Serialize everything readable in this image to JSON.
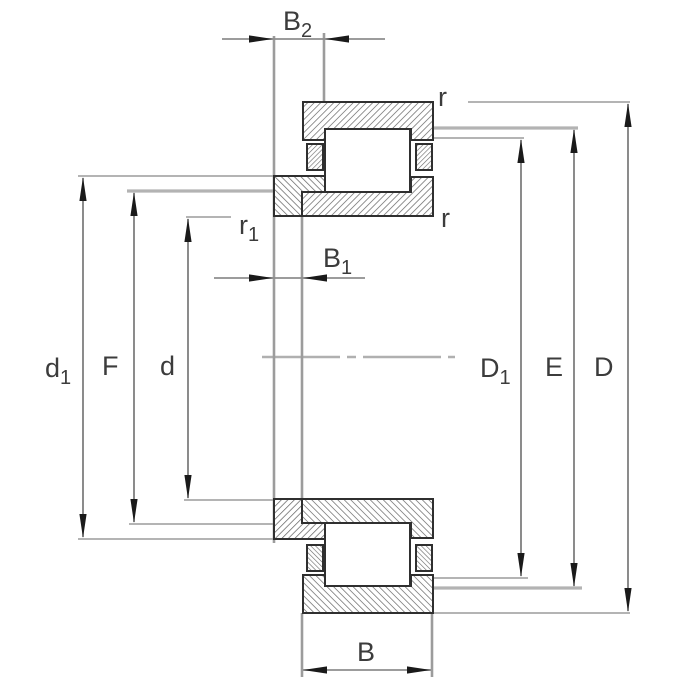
{
  "drawing": {
    "kind": "bearing-cross-section-technical-drawing",
    "labels": {
      "b2": {
        "base": "B",
        "sub": "2"
      },
      "b1": {
        "base": "B",
        "sub": "1"
      },
      "b": {
        "base": "B",
        "sub": ""
      },
      "d1": {
        "base": "d",
        "sub": "1"
      },
      "f": {
        "base": "F",
        "sub": ""
      },
      "d": {
        "base": "d",
        "sub": ""
      },
      "D1": {
        "base": "D",
        "sub": "1"
      },
      "E": {
        "base": "E",
        "sub": ""
      },
      "D": {
        "base": "D",
        "sub": ""
      },
      "r_top": {
        "base": "r",
        "sub": ""
      },
      "r_mid": {
        "base": "r",
        "sub": ""
      },
      "r1": {
        "base": "r",
        "sub": "1"
      }
    },
    "colors": {
      "background": "#ffffff",
      "outline": "#2f2f2f",
      "hatch": "#6d6d6d",
      "dimension_line": "#5a5a5a",
      "extension_line": "#9c9c9c",
      "arrowhead": "#1a1a1a",
      "centerline": "#b0b0b0",
      "label_text": "#3c3c3c"
    }
  }
}
